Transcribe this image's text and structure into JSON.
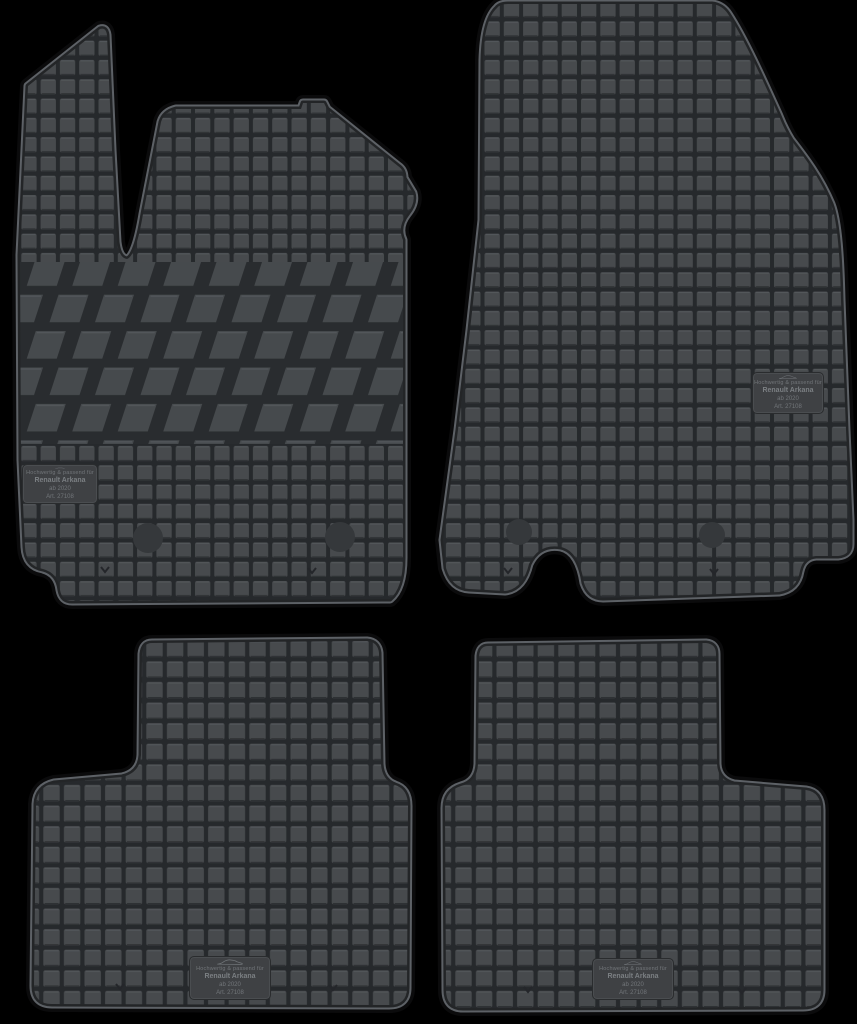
{
  "product": {
    "name": "Rubber car floor mat set, 4 pieces",
    "pieces": [
      {
        "id": "front-left-mat",
        "position": "top-left",
        "texture": "squares + diagonal tread band"
      },
      {
        "id": "front-right-mat",
        "position": "top-right",
        "texture": "squares"
      },
      {
        "id": "rear-left-mat",
        "position": "bottom-left",
        "texture": "squares"
      },
      {
        "id": "rear-right-mat",
        "position": "bottom-right",
        "texture": "squares"
      }
    ]
  },
  "label": {
    "icon": "car-silhouette-icon",
    "line1": "Hochwertig & passend für",
    "vehicle": "Renault Arkana",
    "year": "ab 2020",
    "article": "Art. 27108"
  },
  "colors": {
    "background": "#000000",
    "mat_surface": "#474a4d",
    "mat_groove": "#26292c",
    "rim_highlight": "#5d6166",
    "rim_groove": "#232527",
    "label_patch": "#3f4144",
    "label_text": "#72767a",
    "fixation_dot": "#35383b"
  }
}
